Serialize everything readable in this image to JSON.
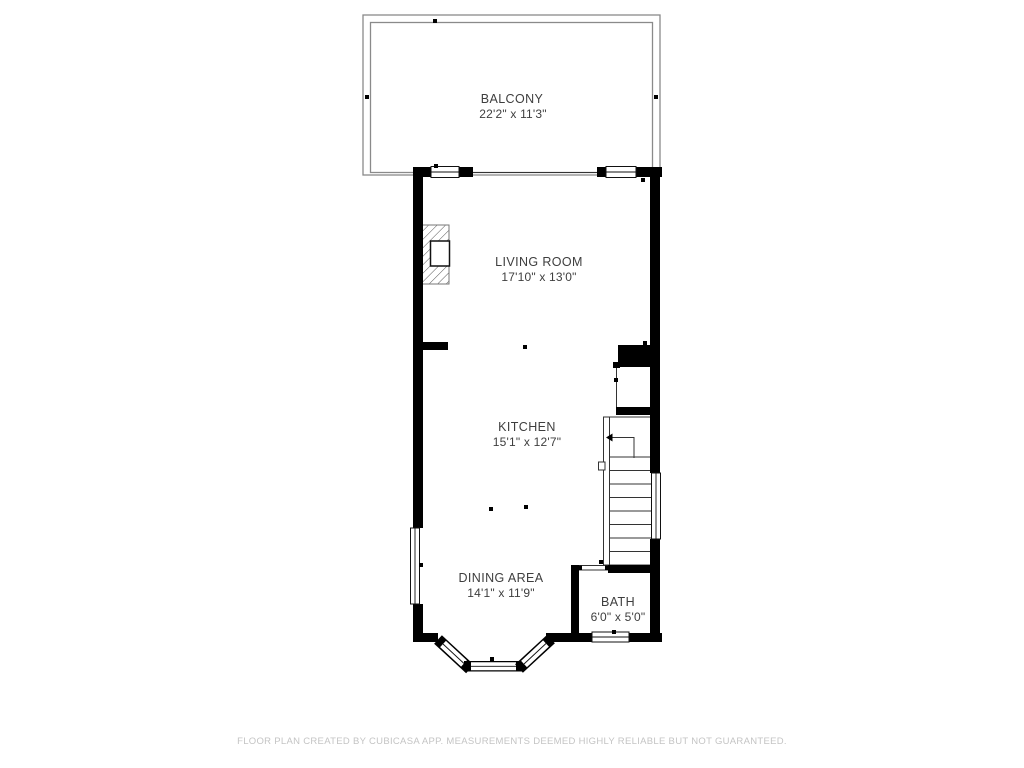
{
  "title": "Floor plan",
  "rooms": [
    {
      "id": "balcony",
      "name": "BALCONY",
      "dimensions": "22'2\" x 11'3\""
    },
    {
      "id": "living-room",
      "name": "LIVING ROOM",
      "dimensions": "17'10\" x 13'0\""
    },
    {
      "id": "kitchen",
      "name": "KITCHEN",
      "dimensions": "15'1\" x 12'7\""
    },
    {
      "id": "dining-area",
      "name": "DINING AREA",
      "dimensions": "14'1\" x 11'9\""
    },
    {
      "id": "bath",
      "name": "BATH",
      "dimensions": "6'0\" x 5'0\""
    }
  ],
  "features": [
    "balcony-railing",
    "fireplace",
    "staircase",
    "bay-window",
    "door-swing"
  ],
  "footer": {
    "disclaimer": "FLOOR PLAN CREATED BY CUBICASA APP. MEASUREMENTS DEEMED HIGHLY RELIABLE BUT NOT GUARANTEED."
  },
  "colors": {
    "wall": "#000000",
    "railing": "#8a8a8a",
    "room_text": "#3e3e3e",
    "footer_text": "#c4c4c4",
    "background": "#ffffff"
  }
}
